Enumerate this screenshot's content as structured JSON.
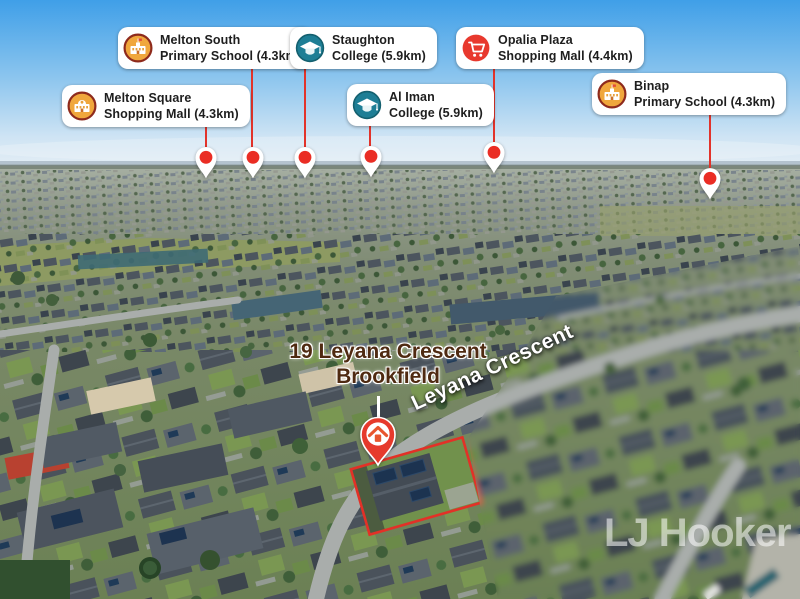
{
  "property": {
    "address_line1": "19 Leyana Crescent",
    "address_line2": "Brookfield"
  },
  "street_label": "Leyana Crescent",
  "watermark": "LJ Hooker",
  "callouts": [
    {
      "name": "melton-south-primary-school",
      "line1": "Melton South",
      "line2": "Primary School (4.3km)",
      "icon": "school-icon"
    },
    {
      "name": "staughton-college",
      "line1": "Staughton",
      "line2": "College (5.9km)",
      "icon": "college-icon"
    },
    {
      "name": "opalia-plaza-shopping-mall",
      "line1": "Opalia Plaza",
      "line2": "Shopping Mall (4.4km)",
      "icon": "shopping-cart-icon"
    },
    {
      "name": "melton-square-shopping-mall",
      "line1": "Melton Square",
      "line2": "Shopping Mall (4.3km)",
      "icon": "mall-icon"
    },
    {
      "name": "al-iman-college",
      "line1": "Al Iman",
      "line2": "College (5.9km)",
      "icon": "college-icon"
    },
    {
      "name": "binap-primary-school",
      "line1": "Binap",
      "line2": "Primary School (4.3km)",
      "icon": "school-icon"
    }
  ],
  "colors": {
    "pin_red": "#ea2d24",
    "home_pin_red": "#e63a2c",
    "school_icon_orange": "#f0a73c",
    "college_icon_teal": "#1e7e95",
    "cart_icon_red": "#e8392e",
    "property_outline_red": "#e23127",
    "address_text_brown": "#4f2a11"
  }
}
